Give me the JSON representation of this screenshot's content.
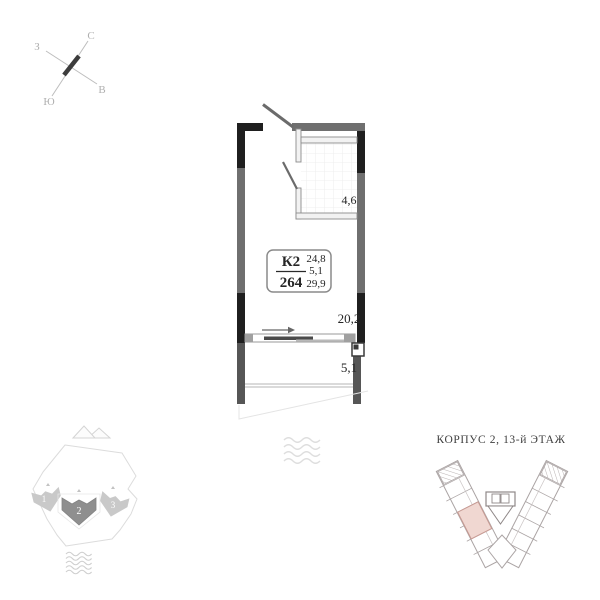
{
  "compass": {
    "north": "С",
    "east": "В",
    "south": "Ю",
    "west": "З"
  },
  "unit_card": {
    "block": "К2",
    "unit_number": "264",
    "areas": {
      "living": "24,8",
      "extra": "5,1",
      "total": "29,9"
    }
  },
  "rooms": {
    "bathroom_area": "4,6",
    "living_area": "20,2",
    "balcony_area": "5,1"
  },
  "site_map": {
    "building_labels": [
      "1",
      "2",
      "3"
    ],
    "highlighted_building": "2"
  },
  "floor_diagram": {
    "title": "КОРПУС 2, 13-й ЭТАЖ"
  },
  "colors": {
    "wall_dark": "#1f1f1f",
    "wall_gray": "#6f6f6f",
    "balcony_wall": "#565656",
    "unit_highlight_fill": "#f0d7d1",
    "unit_highlight_stroke": "#c79a93",
    "building_highlight_fill": "#8f8f8f",
    "building_light_fill": "#c9c9c9"
  }
}
